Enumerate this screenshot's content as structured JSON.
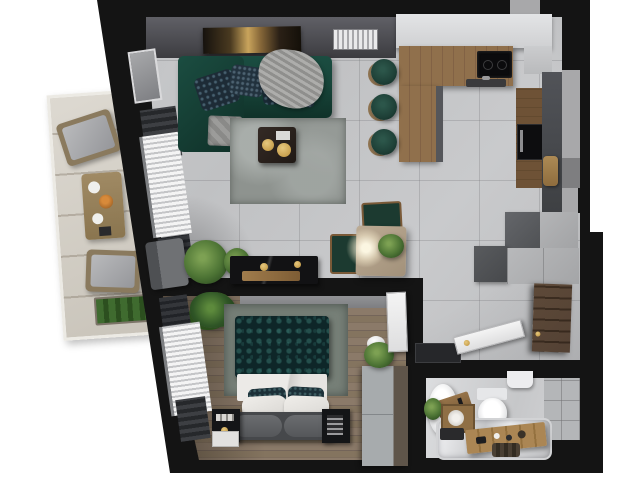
{
  "scene": {
    "label": "3D rendered apartment floor plan, top-down view",
    "background": "#ffffff",
    "style": "photorealistic render, no text"
  },
  "palette": {
    "wall": "#141414",
    "concrete_floor": "#c5c6c8",
    "wall_face": "#55555b",
    "wood_floor": "#7e6f5e",
    "kitchen_wood": "#8a6a48",
    "cabinet_wood": "#6b4f33",
    "counter_white": "#d9dadc",
    "sofa_green": "#17453a",
    "stool_green": "#1e4037",
    "pillow_navy": "#1d2b36",
    "blanket_gray": "#a4a4a2",
    "rug_gray": "#8e938f",
    "bedroom_rug": "#778078",
    "duvet_teal": "#0e2628",
    "linen_white": "#e9e7e3",
    "tile_light": "#d5d6d8",
    "tile_mid": "#b4b6b8",
    "door_wood": "#4a3729",
    "door_white": "#f0f0f0",
    "gold": "#c9a14f",
    "plant_green": "#4c7334",
    "fern_green": "#2f5526",
    "exterior_gray": "#a8a8aa",
    "balcony_stone": "#d8d4cc"
  },
  "rooms": {
    "living_room": {
      "label": "Living room",
      "furniture": [
        "corner-sofa-green",
        "throw-pillows",
        "gray-knit-blanket",
        "patterned-ottoman",
        "area-rug",
        "coffee-table-with-trays",
        "wall-artwork",
        "ceiling-vent",
        "window-blinds",
        "curtains",
        "picture-frame",
        "lounge-chair",
        "marble-console-table",
        "wooden-tray",
        "candles",
        "potted-plants"
      ]
    },
    "kitchen": {
      "label": "Kitchen",
      "furniture": [
        "l-shaped-wood-counter",
        "breakfast-bar",
        "bar-stools-green-x3",
        "induction-cooktop",
        "sink-with-faucet",
        "white-countertop",
        "tall-wood-cabinets",
        "built-in-oven",
        "cutting-board"
      ]
    },
    "dining_area": {
      "label": "Dining area",
      "furniture": [
        "square-dining-table",
        "dining-chairs-x2",
        "pendant-lamp-glow",
        "table-plant"
      ]
    },
    "bedroom": {
      "label": "Bedroom",
      "furniture": [
        "double-bed",
        "teal-patterned-duvet",
        "white-sheet",
        "pillows-dark-x2",
        "pillows-white-x2",
        "upholstered-headboard",
        "nightstands-x2",
        "white-tray",
        "area-rug",
        "dresser",
        "round-mirror",
        "potted-plants-x3",
        "window-blinds",
        "curtains",
        "white-door"
      ]
    },
    "hallway": {
      "label": "Hallway / entry",
      "furniture": [
        "wardrobe-cabinets-x4",
        "entrance-door-wood",
        "doormat",
        "bathroom-door-white"
      ]
    },
    "bathroom": {
      "label": "Bathroom",
      "furniture": [
        "bathtub",
        "wooden-bath-caddy",
        "black-faucet",
        "oval-washbasin",
        "wood-shelf",
        "toilet",
        "paper-holder",
        "plant",
        "wooden-crate-with-towel",
        "dark-basket",
        "gray-tile-zone"
      ]
    },
    "balcony": {
      "label": "Balcony",
      "furniture": [
        "outdoor-armchair-top",
        "outdoor-armchair-bottom",
        "outdoor-coffee-table",
        "tableware",
        "planter-box"
      ]
    }
  }
}
